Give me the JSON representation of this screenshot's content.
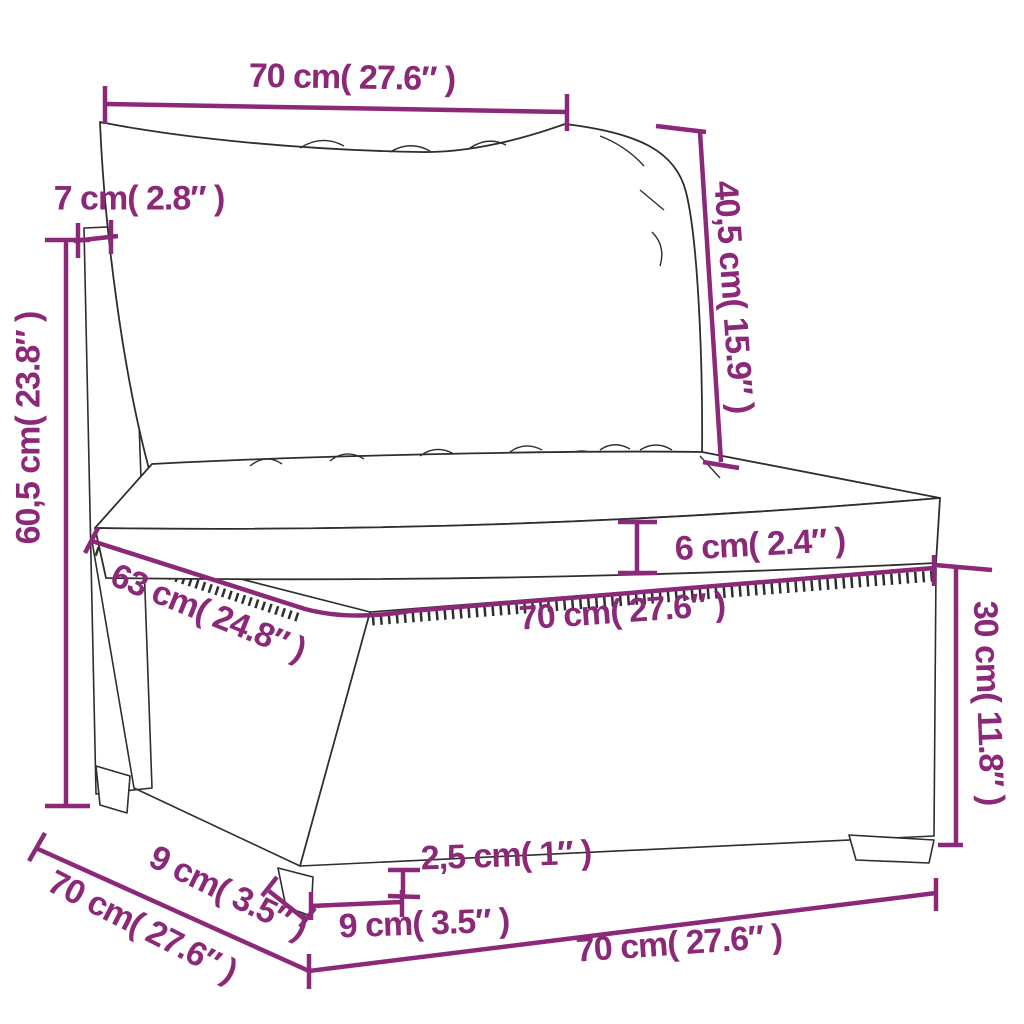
{
  "colors": {
    "accent": "#8b2878",
    "ink": "#2e2e2e",
    "background": "#ffffff"
  },
  "labels": {
    "top_width": "70 cm( 27.6″ )",
    "back_cushion_height": "40,5 cm( 15.9″ )",
    "back_thickness": "7 cm( 2.8″ )",
    "back_height": "60,5 cm( 23.8″ )",
    "cushion_thickness": "6 cm( 2.4″ )",
    "seat_width": "70 cm( 27.6″ )",
    "base_height": "30 cm( 11.8″ )",
    "seat_depth": "63 cm( 24.8″ )",
    "foot_inset": "9 cm( 3.5″ )",
    "total_depth": "70 cm( 27.6″ )",
    "leg_height": "2,5 cm( 1″ )",
    "foot_width": "9 cm( 3.5″ )",
    "bottom_width": "70 cm( 27.6″ )"
  }
}
